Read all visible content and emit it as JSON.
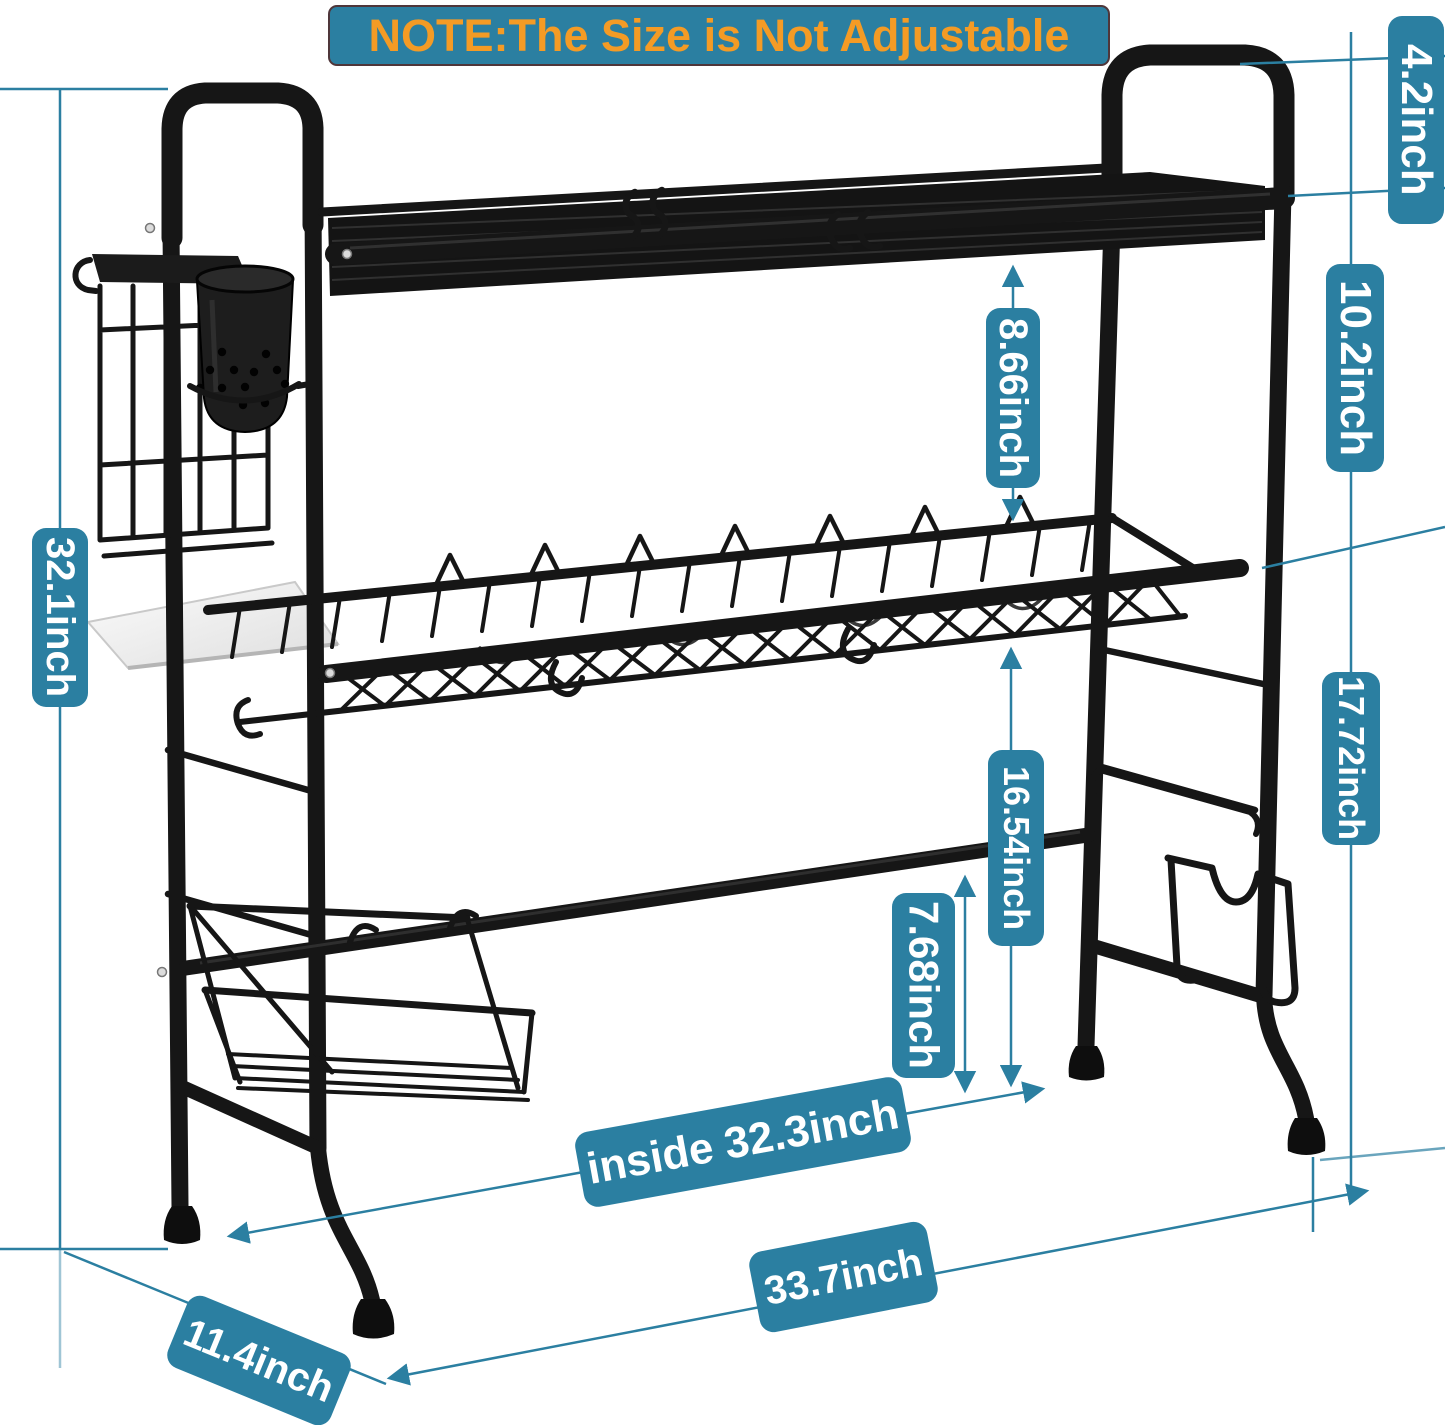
{
  "note": "NOTE:The Size is Not Adjustable",
  "dimensions": {
    "handle_height": "4.2inch",
    "top_to_middle_shelf": "10.2inch",
    "shelf_gap": "8.66inch",
    "total_height": "32.1inch",
    "middle_shelf_clearance": "16.54inch",
    "crossbar_clearance": "7.68inch",
    "middle_to_counter": "17.72inch",
    "inside_width": "inside 32.3inch",
    "overall_width": "33.7inch",
    "depth": "11.4inch"
  },
  "colors": {
    "label_bg": "#2b7fa1",
    "label_text": "#ffffff",
    "note_text": "#f49b25",
    "dim_line": "#2b7fa1",
    "rack_dark": "#161616"
  }
}
